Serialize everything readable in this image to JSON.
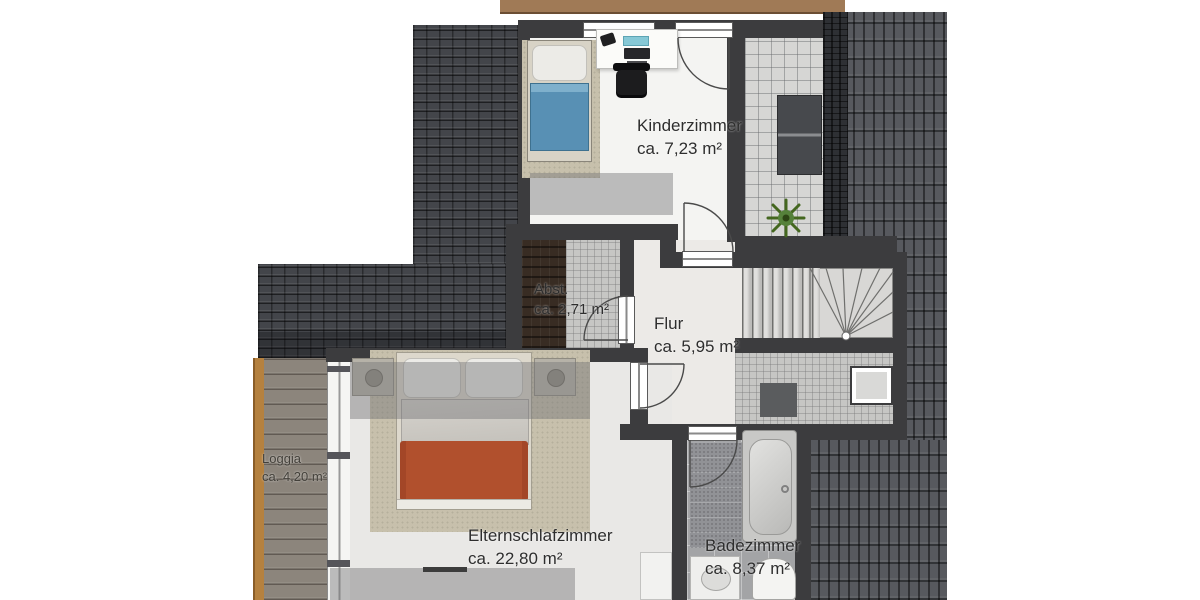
{
  "floor_plan": {
    "rooms": [
      {
        "name": "Kinderzimmer",
        "area": "ca. 7,23 m²"
      },
      {
        "name": "Abst.",
        "area": "ca. 2,71 m²"
      },
      {
        "name": "Flur",
        "area": "ca. 5,95 m²"
      },
      {
        "name": "Elternschlafzimmer",
        "area": "ca. 22,80 m²"
      },
      {
        "name": "Badezimmer",
        "area": "ca. 8,37 m²"
      },
      {
        "name": "Loggia",
        "area": "ca. 4,20 m²"
      }
    ],
    "colors": {
      "roof_dark": "#43454a",
      "roof_field": "#57595e",
      "roof_ridge": "#2e3034",
      "terrace_tile": "#d6d6d4",
      "wall": "#3c3c3e",
      "wood_deck": "#8c857c",
      "deck_beam": "#b5813f",
      "fascia": "#a07a56",
      "kid_bed_blue": "#5890b4",
      "parent_bed_red": "#b1502d",
      "rug_beige": "#c7c0ac",
      "plant_green": "#4e7a2e"
    },
    "objects": {
      "kinderzimmer": [
        "single-bed",
        "rug",
        "desk",
        "phone",
        "laptop",
        "monitor",
        "office-chair"
      ],
      "elternschlafzimmer": [
        "double-bed",
        "nightstand-left",
        "nightstand-right",
        "rug",
        "dresser"
      ],
      "badezimmer": [
        "shower-area",
        "bathtub",
        "washbasin",
        "toilet"
      ],
      "stairs_area": [
        "staircase",
        "chimney",
        "doormat"
      ],
      "roof_terrace": [
        "sideboard",
        "plant"
      ]
    }
  }
}
